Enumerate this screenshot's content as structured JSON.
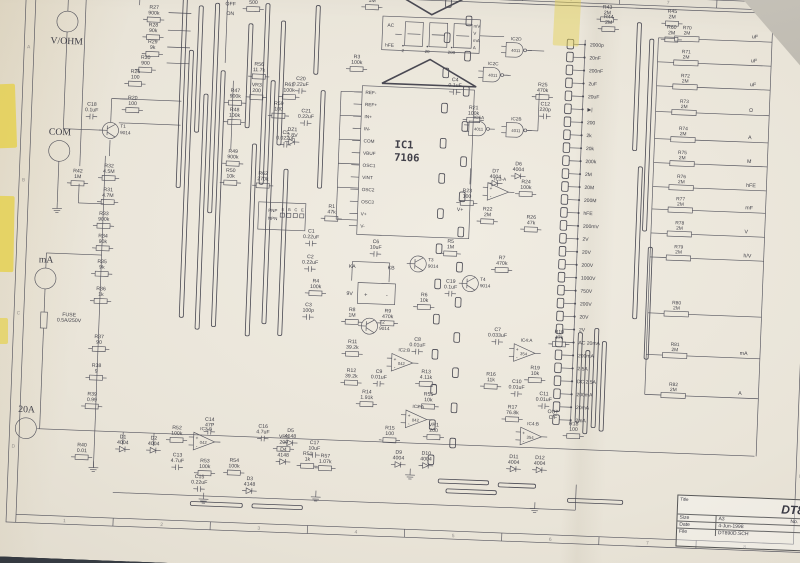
{
  "photo": {
    "desk_color": "#383d44",
    "paper_color": "#e9e4d8",
    "tape_color": "#e5d14e",
    "under_sheet_color": "#c2beb4"
  },
  "sheet": {
    "title_block": {
      "title_label": "Title",
      "model": "DT890D",
      "size_label": "Size",
      "size": "A3",
      "number_label": "No.",
      "date_label": "Date",
      "date": "4-Jun-1998",
      "file_label": "File",
      "file": "DT890D.SCH"
    },
    "zones_top": [
      "1",
      "2",
      "3",
      "4",
      "5",
      "6",
      "7",
      "8"
    ],
    "zones_side": [
      "A",
      "B",
      "C",
      "D"
    ]
  },
  "terminals": [
    {
      "x": 62,
      "y": 66,
      "label": "V/OHM",
      "ly": 94
    },
    {
      "x": 58,
      "y": 228,
      "label": "COM",
      "ly": 208
    },
    {
      "x": 47,
      "y": 388,
      "label": "mA",
      "ly": 368
    },
    {
      "x": 30,
      "y": 576,
      "label": "20A",
      "ly": 556
    }
  ],
  "display": {
    "x": 450,
    "y": 44,
    "w": 120,
    "h": 42,
    "flags": [
      "AC",
      "hFE"
    ],
    "decimals": [
      "2",
      "20",
      "200"
    ],
    "units": [
      "mV",
      "V",
      "mA",
      "A"
    ]
  },
  "ic1": {
    "x": 428,
    "y": 132,
    "w": 138,
    "h": 186,
    "ref": "IC1",
    "part": "7106",
    "pins": [
      "REF-",
      "REF+",
      "IN+",
      "IN-",
      "COM",
      "VBUF",
      "OSC1",
      "VINT",
      "OSC2",
      "OSC3",
      "V+",
      "V-"
    ]
  },
  "gates": [
    {
      "x": 617,
      "y": 80,
      "name": "IC2D",
      "part": "4011"
    },
    {
      "x": 590,
      "y": 112,
      "name": "IC2C",
      "part": "4011"
    },
    {
      "x": 575,
      "y": 180,
      "name": "IC5A",
      "part": "4011"
    },
    {
      "x": 621,
      "y": 180,
      "name": "IC2B",
      "part": "4011"
    }
  ],
  "opamps": [
    {
      "x": 600,
      "y": 258,
      "name": "IC3-A",
      "part": ""
    },
    {
      "x": 250,
      "y": 584,
      "name": "IC3-B",
      "part": "042"
    },
    {
      "x": 490,
      "y": 476,
      "name": "IC2:B",
      "part": "042"
    },
    {
      "x": 510,
      "y": 546,
      "name": "IC2:A",
      "part": "042"
    },
    {
      "x": 640,
      "y": 458,
      "name": "IC4:A",
      "part": "354"
    },
    {
      "x": 652,
      "y": 562,
      "name": "IC4:B",
      "part": "354"
    }
  ],
  "transistors": [
    {
      "x": 120,
      "y": 200,
      "ref": "T1",
      "part": "9014"
    },
    {
      "x": 448,
      "y": 432,
      "ref": "T2",
      "part": "9014"
    },
    {
      "x": 505,
      "y": 352,
      "ref": "T3",
      "part": "9014"
    },
    {
      "x": 570,
      "y": 374,
      "ref": "T4",
      "part": "9014"
    }
  ],
  "battery": {
    "x": 432,
    "y": 378,
    "w": 46,
    "h": 26,
    "label": "9V",
    "plus": "+",
    "minus": "-"
  },
  "hfe": {
    "x": 306,
    "y": 282,
    "w": 58,
    "h": 34,
    "rows": [
      "PNP",
      "NPN"
    ],
    "pins": [
      "E",
      "B",
      "C",
      "E"
    ]
  },
  "fuse": {
    "x": 43,
    "y": 430,
    "label": "FUSE 0.5A/250V"
  },
  "ranges": [
    "2000p",
    "20nF",
    "200nF",
    "2uF",
    "20uF",
    "▶|",
    "200",
    "2k",
    "20k",
    "200k",
    "2M",
    "20M",
    "200M",
    "hFE",
    "200mV",
    "2V",
    "20V",
    "200V",
    "1000V",
    "750V",
    "200V",
    "20V",
    "2V",
    "AC 20mA",
    "200mA",
    "2.5A",
    "DC 2.5A",
    "200mA",
    "20mA",
    "2mA"
  ],
  "outputs": [
    {
      "ref": "R70",
      "value": "2M",
      "out": "uF",
      "y": 58
    },
    {
      "ref": "R71",
      "value": "2M",
      "out": "uF",
      "y": 88
    },
    {
      "ref": "R72",
      "value": "2M",
      "out": "uF",
      "y": 118
    },
    {
      "ref": "R73",
      "value": "2M",
      "out": "Ω",
      "y": 150
    },
    {
      "ref": "R74",
      "value": "2M",
      "out": "A",
      "y": 184
    },
    {
      "ref": "R75",
      "value": "2M",
      "out": "M",
      "y": 214
    },
    {
      "ref": "R76",
      "value": "2M",
      "out": "hFE",
      "y": 244
    },
    {
      "ref": "R77",
      "value": "2M",
      "out": "mF",
      "y": 272
    },
    {
      "ref": "R78",
      "value": "2M",
      "out": "V",
      "y": 302
    },
    {
      "ref": "R79",
      "value": "2M",
      "out": "h/V",
      "y": 332
    },
    {
      "ref": "R80",
      "value": "2M",
      "out": "",
      "y": 402
    },
    {
      "ref": "R81",
      "value": "2M",
      "out": "mA",
      "y": 454
    },
    {
      "ref": "R82",
      "value": "2M",
      "out": "A",
      "y": 504
    }
  ],
  "labels": [
    {
      "t": "R27 900k",
      "x": 168,
      "y": 46
    },
    {
      "t": "R28 90k",
      "x": 168,
      "y": 68
    },
    {
      "t": "R29 9k",
      "x": 168,
      "y": 89
    },
    {
      "t": "R30 900",
      "x": 160,
      "y": 109
    },
    {
      "t": "R26 100",
      "x": 148,
      "y": 127
    },
    {
      "t": "PTC 500",
      "x": 290,
      "y": 28
    },
    {
      "t": "OFF",
      "x": 262,
      "y": 38,
      "s": 1
    },
    {
      "t": "ON",
      "x": 262,
      "y": 50,
      "s": 1
    },
    {
      "t": "R2 1M",
      "x": 436,
      "y": 20
    },
    {
      "t": "R3 100k",
      "x": 420,
      "y": 98
    },
    {
      "t": "C20 0.22uF",
      "x": 352,
      "y": 128
    },
    {
      "t": "C21 0.22uF",
      "x": 360,
      "y": 168
    },
    {
      "t": "C5 0.022uF",
      "x": 336,
      "y": 196
    },
    {
      "t": "C4 0.1uF",
      "x": 542,
      "y": 122
    },
    {
      "t": "R1 47k",
      "x": 396,
      "y": 286
    },
    {
      "t": "C1 0.22uF",
      "x": 372,
      "y": 318
    },
    {
      "t": "C2 0.22uF",
      "x": 372,
      "y": 350
    },
    {
      "t": "R4 100k",
      "x": 380,
      "y": 380
    },
    {
      "t": "C3 100p",
      "x": 372,
      "y": 410
    },
    {
      "t": "R21 100k",
      "x": 566,
      "y": 156
    },
    {
      "t": "R25 470k",
      "x": 650,
      "y": 124
    },
    {
      "t": "C12 220p",
      "x": 654,
      "y": 148
    },
    {
      "t": "C18 0.1uF",
      "x": 96,
      "y": 170
    },
    {
      "t": "R20 100",
      "x": 146,
      "y": 160
    },
    {
      "t": "R42 1M",
      "x": 82,
      "y": 254
    },
    {
      "t": "R32 4.5M",
      "x": 120,
      "y": 246
    },
    {
      "t": "R31 4.7M",
      "x": 120,
      "y": 276
    },
    {
      "t": "R33 900k",
      "x": 116,
      "y": 306
    },
    {
      "t": "R34 90k",
      "x": 116,
      "y": 334
    },
    {
      "t": "R35 9k",
      "x": 116,
      "y": 366
    },
    {
      "t": "R36 1k",
      "x": 116,
      "y": 400
    },
    {
      "t": "R37 90",
      "x": 116,
      "y": 460
    },
    {
      "t": "R38 9",
      "x": 114,
      "y": 496
    },
    {
      "t": "R39 0.99",
      "x": 110,
      "y": 532
    },
    {
      "t": "R40 0.01",
      "x": 100,
      "y": 596
    },
    {
      "t": "R47 900k",
      "x": 272,
      "y": 146
    },
    {
      "t": "R48 100k",
      "x": 272,
      "y": 170
    },
    {
      "t": "R49 900k",
      "x": 272,
      "y": 222
    },
    {
      "t": "R50 10k",
      "x": 270,
      "y": 246
    },
    {
      "t": "R56 11.7k",
      "x": 300,
      "y": 112
    },
    {
      "t": "VR3 200",
      "x": 298,
      "y": 138
    },
    {
      "t": "R61 100k",
      "x": 338,
      "y": 136
    },
    {
      "t": "R59 100",
      "x": 326,
      "y": 160
    },
    {
      "t": "DZ1 2.8V",
      "x": 344,
      "y": 192
    },
    {
      "t": "R62 270k",
      "x": 310,
      "y": 248
    },
    {
      "t": "R23 100",
      "x": 562,
      "y": 260
    },
    {
      "t": "D6 4004",
      "x": 624,
      "y": 224
    },
    {
      "t": "D7 4004",
      "x": 596,
      "y": 234
    },
    {
      "t": "R24 100k",
      "x": 634,
      "y": 246
    },
    {
      "t": "R22 2M",
      "x": 588,
      "y": 282
    },
    {
      "t": "R26 47k",
      "x": 642,
      "y": 290
    },
    {
      "t": "V+",
      "x": 554,
      "y": 284,
      "s": 1
    },
    {
      "t": "C6 10uF",
      "x": 452,
      "y": 328
    },
    {
      "t": "KA",
      "x": 424,
      "y": 360,
      "s": 1
    },
    {
      "t": "KB",
      "x": 472,
      "y": 360,
      "s": 1
    },
    {
      "t": "R8 1M",
      "x": 426,
      "y": 414
    },
    {
      "t": "R9 470k",
      "x": 470,
      "y": 414
    },
    {
      "t": "R5 1M",
      "x": 544,
      "y": 324
    },
    {
      "t": "C19 0.1uF",
      "x": 546,
      "y": 374
    },
    {
      "t": "R6 10k",
      "x": 514,
      "y": 392
    },
    {
      "t": "R7 470k",
      "x": 608,
      "y": 342
    },
    {
      "t": "C7 0.033uF",
      "x": 606,
      "y": 432
    },
    {
      "t": "R10 47k",
      "x": 682,
      "y": 432
    },
    {
      "t": "R11 39.2k",
      "x": 428,
      "y": 454
    },
    {
      "t": "C8 0.01uF",
      "x": 508,
      "y": 448
    },
    {
      "t": "R12 39.2k",
      "x": 428,
      "y": 490
    },
    {
      "t": "C9 0.01uF",
      "x": 462,
      "y": 490
    },
    {
      "t": "R13 4.11k",
      "x": 520,
      "y": 488
    },
    {
      "t": "R14 1.91k",
      "x": 448,
      "y": 516
    },
    {
      "t": "R55 10k",
      "x": 524,
      "y": 516
    },
    {
      "t": "R16 11k",
      "x": 600,
      "y": 488
    },
    {
      "t": "R19 10k",
      "x": 654,
      "y": 478
    },
    {
      "t": "C10 0.01uF",
      "x": 632,
      "y": 496
    },
    {
      "t": "C11 0.01uF",
      "x": 666,
      "y": 510
    },
    {
      "t": "R17 76.8k",
      "x": 628,
      "y": 528
    },
    {
      "t": "OUT C/F",
      "x": 678,
      "y": 532,
      "s": 2
    },
    {
      "t": "R18 100",
      "x": 704,
      "y": 546
    },
    {
      "t": "R15 100",
      "x": 478,
      "y": 560
    },
    {
      "t": "VR1 200",
      "x": 532,
      "y": 554
    },
    {
      "t": "C17 10uF",
      "x": 386,
      "y": 582
    },
    {
      "t": "VR4 200",
      "x": 348,
      "y": 576
    },
    {
      "t": "R57 1.07k",
      "x": 400,
      "y": 598
    },
    {
      "t": "R51 1k",
      "x": 378,
      "y": 596
    },
    {
      "t": "D4 4148",
      "x": 348,
      "y": 592
    },
    {
      "t": "D5 4148",
      "x": 356,
      "y": 568
    },
    {
      "t": "C16 4.7uF",
      "x": 322,
      "y": 564
    },
    {
      "t": "D3 4148",
      "x": 308,
      "y": 630
    },
    {
      "t": "C15 0.22uF",
      "x": 246,
      "y": 630
    },
    {
      "t": "R53 100k",
      "x": 252,
      "y": 610
    },
    {
      "t": "R54 100k",
      "x": 288,
      "y": 608
    },
    {
      "t": "C13 4.7uF",
      "x": 218,
      "y": 604
    },
    {
      "t": "C14 47P",
      "x": 256,
      "y": 558
    },
    {
      "t": "R52 100k",
      "x": 216,
      "y": 570
    },
    {
      "t": "D1 4004",
      "x": 150,
      "y": 584
    },
    {
      "t": "D2 4004",
      "x": 188,
      "y": 584
    },
    {
      "t": "D9 4004",
      "x": 490,
      "y": 590
    },
    {
      "t": "D10 4004",
      "x": 524,
      "y": 590
    },
    {
      "t": "D11 4004",
      "x": 632,
      "y": 590
    },
    {
      "t": "D12 4004",
      "x": 664,
      "y": 590
    },
    {
      "t": "R43 2M",
      "x": 726,
      "y": 24
    },
    {
      "t": "R44 2M",
      "x": 728,
      "y": 36
    },
    {
      "t": "R45 2M",
      "x": 806,
      "y": 26
    },
    {
      "t": "R60 2M",
      "x": 806,
      "y": 46
    },
    {
      "t": "FUSE 0.5A/250V",
      "x": 78,
      "y": 434,
      "s": 2
    }
  ],
  "bars": [
    [
      206,
      32,
      268
    ],
    [
      216,
      96,
      430
    ],
    [
      226,
      40,
      198
    ],
    [
      236,
      150,
      444
    ],
    [
      246,
      36,
      298
    ],
    [
      256,
      120,
      440
    ],
    [
      288,
      60,
      190
    ],
    [
      298,
      210,
      450
    ],
    [
      308,
      34,
      260
    ],
    [
      318,
      130,
      434
    ],
    [
      328,
      55,
      210
    ],
    [
      338,
      240,
      448
    ],
    [
      370,
      34,
      120
    ],
    [
      380,
      140,
      262
    ],
    [
      728,
      424,
      548
    ],
    [
      738,
      440,
      552
    ],
    [
      708,
      430,
      542
    ],
    [
      718,
      452,
      556
    ],
    [
      766,
      40,
      200
    ],
    [
      774,
      220,
      410
    ],
    [
      782,
      60,
      300
    ],
    [
      790,
      320,
      460
    ]
  ],
  "hbars": [
    [
      540,
      602,
      622
    ],
    [
      550,
      612,
      634
    ],
    [
      614,
      660,
      624
    ],
    [
      236,
      300,
      662
    ],
    [
      312,
      374,
      662
    ],
    [
      700,
      768,
      640
    ]
  ],
  "padcols": [
    {
      "x": 530,
      "y0": 24,
      "n": 14,
      "step": 44
    },
    {
      "x": 556,
      "y0": 46,
      "n": 13,
      "step": 44
    }
  ],
  "wires": [
    [
      62,
      22,
      930,
      22
    ],
    [
      930,
      22,
      930,
      576
    ],
    [
      62,
      22,
      62,
      53
    ],
    [
      58,
      241,
      58,
      292
    ],
    [
      47,
      375,
      47,
      356
    ],
    [
      47,
      356,
      115,
      356
    ],
    [
      47,
      401,
      47,
      430
    ],
    [
      47,
      450,
      47,
      576
    ],
    [
      44,
      576,
      928,
      576
    ],
    [
      115,
      232,
      115,
      616
    ],
    [
      84,
      22,
      84,
      246
    ],
    [
      84,
      268,
      84,
      292
    ],
    [
      84,
      292,
      115,
      292
    ],
    [
      62,
      79,
      62,
      200
    ],
    [
      62,
      200,
      110,
      200
    ],
    [
      120,
      190,
      120,
      160
    ],
    [
      120,
      160,
      150,
      160
    ],
    [
      150,
      22,
      150,
      42
    ],
    [
      186,
      50,
      214,
      50
    ],
    [
      186,
      72,
      214,
      72
    ],
    [
      186,
      93,
      214,
      93
    ],
    [
      186,
      113,
      214,
      113
    ],
    [
      130,
      160,
      206,
      160
    ],
    [
      130,
      190,
      206,
      190
    ],
    [
      258,
      22,
      258,
      110
    ],
    [
      269,
      132,
      269,
      218
    ],
    [
      700,
      64,
      700,
      548
    ],
    [
      790,
      58,
      790,
      504
    ],
    [
      570,
      64,
      600,
      64
    ],
    [
      630,
      80,
      650,
      80
    ],
    [
      604,
      112,
      610,
      112
    ],
    [
      633,
      180,
      646,
      180
    ],
    [
      646,
      180,
      646,
      132
    ],
    [
      402,
      140,
      428,
      140
    ],
    [
      402,
      140,
      402,
      300
    ],
    [
      402,
      300,
      428,
      300
    ],
    [
      402,
      170,
      428,
      170
    ],
    [
      402,
      200,
      428,
      200
    ],
    [
      402,
      230,
      428,
      230
    ],
    [
      402,
      260,
      428,
      260
    ],
    [
      140,
      652,
      710,
      652
    ],
    [
      710,
      620,
      710,
      652
    ],
    [
      424,
      352,
      424,
      376
    ],
    [
      470,
      352,
      470,
      376
    ],
    [
      424,
      352,
      470,
      352
    ],
    [
      150,
      576,
      150,
      592
    ],
    [
      188,
      576,
      188,
      592
    ],
    [
      565,
      230,
      565,
      250
    ],
    [
      120,
      212,
      120,
      232
    ],
    [
      115,
      616,
      115,
      622
    ]
  ],
  "grounds": [
    [
      58,
      300
    ],
    [
      115,
      622
    ],
    [
      252,
      656
    ],
    [
      390,
      648
    ],
    [
      505,
      616
    ],
    [
      660,
      652
    ]
  ]
}
